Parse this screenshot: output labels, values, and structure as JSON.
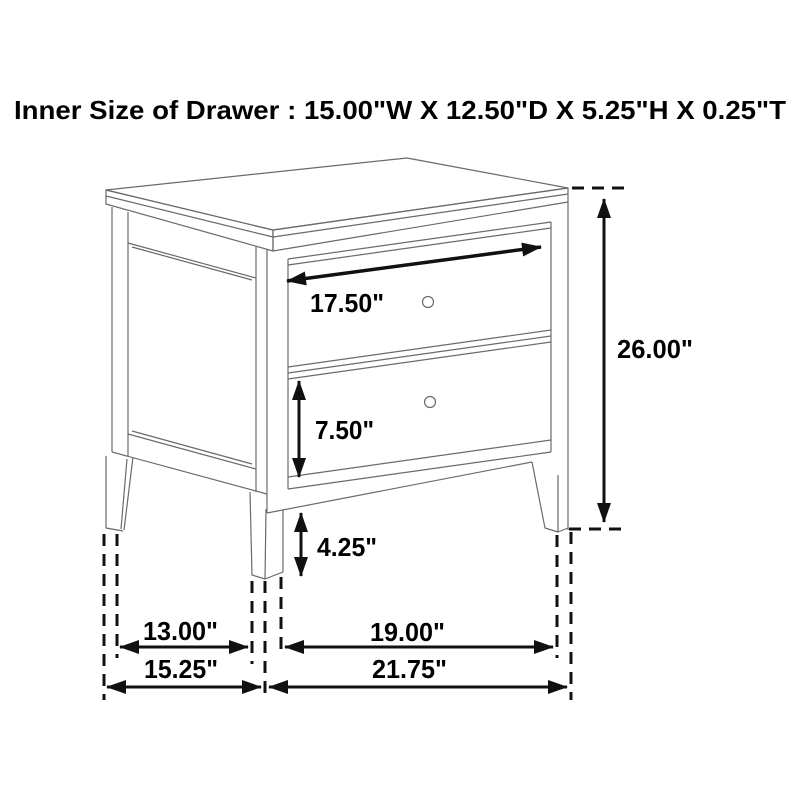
{
  "title": "Inner Size of Drawer : 15.00\"W X 12.50\"D X 5.25\"H X 0.25\"T",
  "inner_drawer_size": {
    "width": "15.00\"",
    "depth": "12.50\"",
    "height": "5.25\"",
    "thickness": "0.25\""
  },
  "furniture": {
    "type": "two-drawer nightstand line drawing",
    "drawer_count": 2,
    "knob_count": 2
  },
  "dimension_labels": {
    "drawer_front_width": "17.50\"",
    "overall_height": "26.00\"",
    "bottom_drawer_front_height": "7.50\"",
    "floor_clearance": "4.25\"",
    "side_leg_spacing": "13.00\"",
    "front_leg_spacing": "19.00\"",
    "overall_depth": "15.25\"",
    "overall_width": "21.75\""
  },
  "colors": {
    "background": "#ffffff",
    "line_art": "#6a6a6a",
    "dimension_ink": "#111111",
    "text": "#000000"
  }
}
